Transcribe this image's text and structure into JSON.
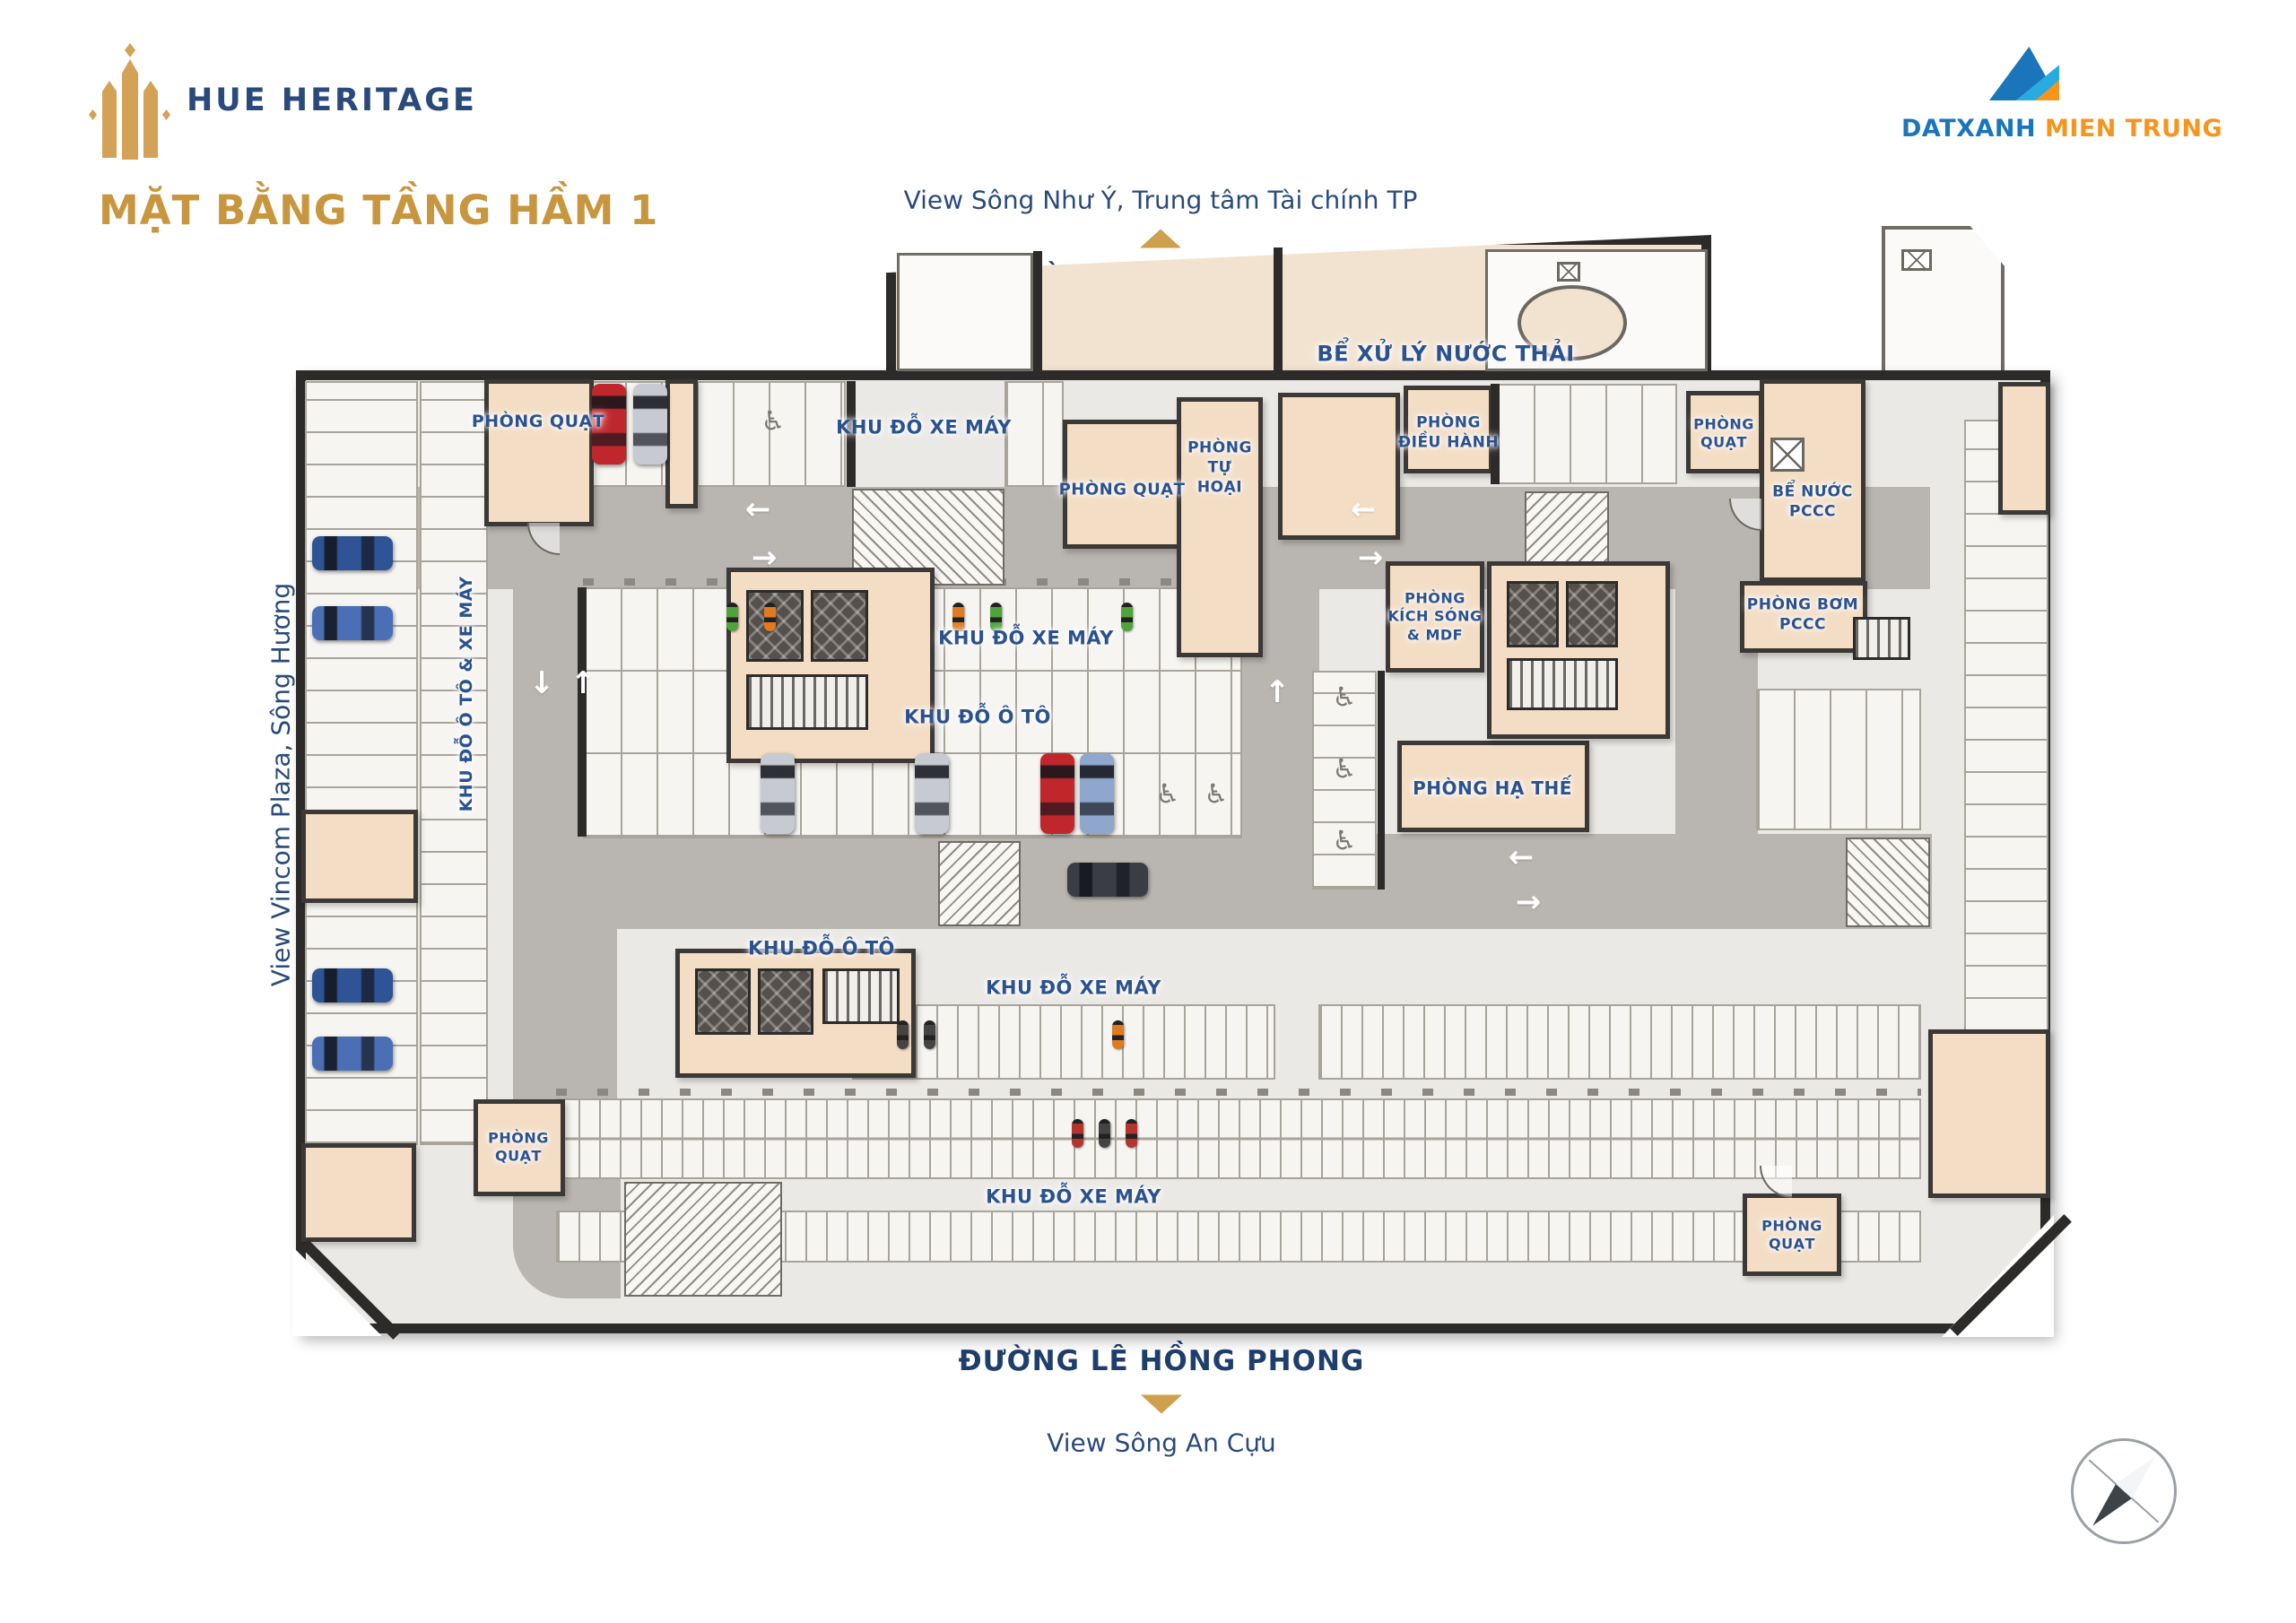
{
  "branding": {
    "logo_text": "HUE HERITAGE",
    "title": "MẶT BẰNG TẦNG HẦM 1",
    "developer": {
      "blue": "DATXANH",
      "orange": " MIEN TRUNG"
    }
  },
  "surroundings": {
    "top": {
      "view": "View Sông Như Ý, Trung tâm Tài chính TP",
      "street": "ĐƯỜNG VÕ VĂN TẦN"
    },
    "left": {
      "view": "View Vincom Plaza, Sông Hương",
      "street": "ĐƯỜNG ĐỐNG ĐA"
    },
    "right": {
      "view": "View Hồ Trái Tim"
    },
    "bottom": {
      "street": "ĐƯỜNG LÊ HỒNG PHONG",
      "view": "View Sông An Cựu"
    }
  },
  "plan": {
    "labels": {
      "phong_quat_tl": "PHÒNG QUẠT",
      "khu_xe_may_top": "KHU ĐỖ XE MÁY",
      "phong_quat_tc": "PHÒNG QUẠT",
      "phong_tu_hoai": "PHÒNG\nTỰ\nHOẠI",
      "be_xu_ly": "BỂ XỬ LÝ NƯỚC THẢI",
      "phong_dieu_hanh": "PHÒNG\nĐIỀU HÀNH",
      "phong_quat_tr": "PHÒNG\nQUẠT",
      "be_nuoc_pccc": "BỂ NƯỚC\nPCCC",
      "phong_bom_pccc": "PHÒNG BƠM\nPCCC",
      "khu_xe_may_mid": "KHU ĐỖ XE MÁY",
      "khu_o_to_mid": "KHU ĐỖ Ô TÔ",
      "kich_song": "PHÒNG\nKÍCH SÓNG\n& MDF",
      "ha_the": "PHÒNG HẠ THẾ",
      "left_col": "KHU ĐỖ Ô TÔ & XE MÁY",
      "khu_o_to_bot": "KHU ĐỖ Ô TÔ",
      "khu_xe_may_b1": "KHU ĐỖ XE MÁY",
      "phong_quat_bl": "PHÒNG\nQUẠT",
      "khu_xe_may_b2": "KHU ĐỖ XE MÁY",
      "phong_quat_br": "PHÒNG\nQUẠT"
    }
  },
  "colors": {
    "gold": "#CE9F4D",
    "title_gold": "#C8963E",
    "navy_street": "#1E3E6E",
    "navy_label": "#2B5290",
    "logo_navy": "#2A4A7B",
    "wall": "#2D2B29",
    "room_beige": "#F3DDC4",
    "road_gray": "#B9B6B1",
    "floor": "#EBE9E5",
    "dx_blue": "#1B75BB",
    "dx_light_blue": "#29ABE2",
    "dx_orange": "#F7941E",
    "car_red": "#C0272D",
    "car_silver": "#C7CBD1",
    "car_blue": "#2F5496",
    "car_dark": "#3A3D44",
    "moped_green": "#4FA33B",
    "moped_orange": "#E07B1F"
  }
}
